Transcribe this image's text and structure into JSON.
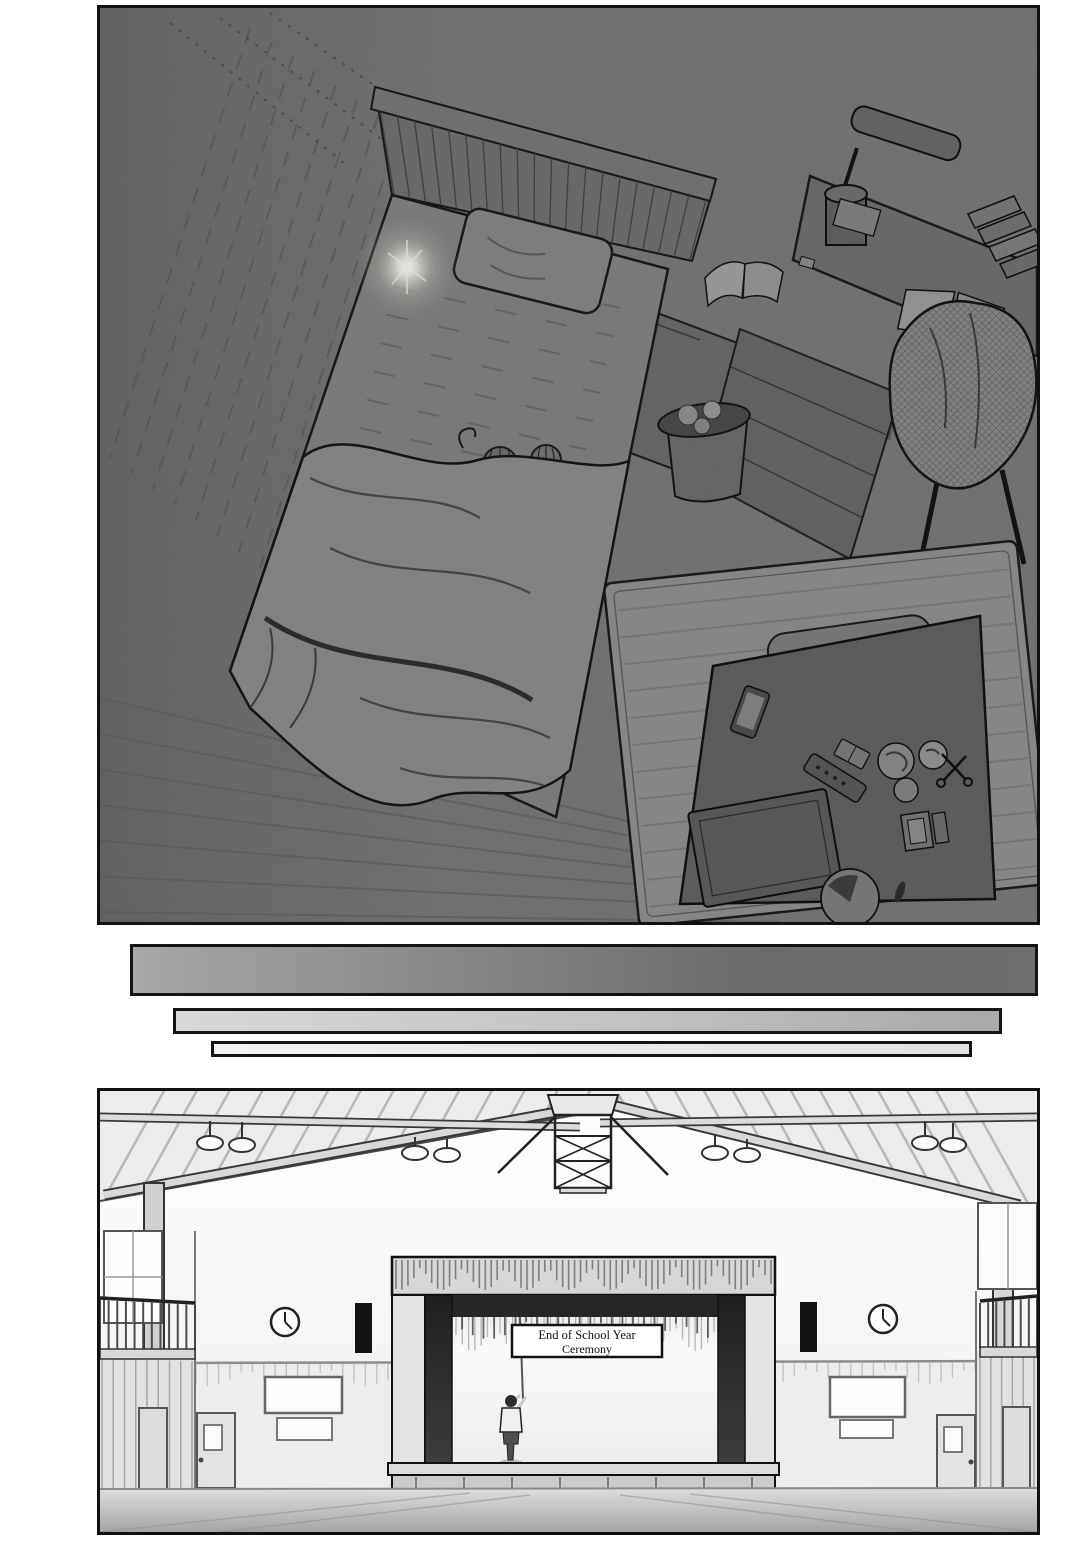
{
  "page": {
    "background": "#ffffff",
    "ink": "#111111"
  },
  "panels": {
    "bedroom": {
      "label": "dark bedroom seen from above at night",
      "base_tone": "#797979"
    },
    "gym": {
      "label": "school gymnasium with stage",
      "banner": {
        "line1": "End of School Year",
        "line2": "Ceremony"
      }
    }
  },
  "transition_bars": {
    "dark": "#6f6f6f",
    "medium": "#bfbfbf",
    "light": "#e9e9e9"
  }
}
